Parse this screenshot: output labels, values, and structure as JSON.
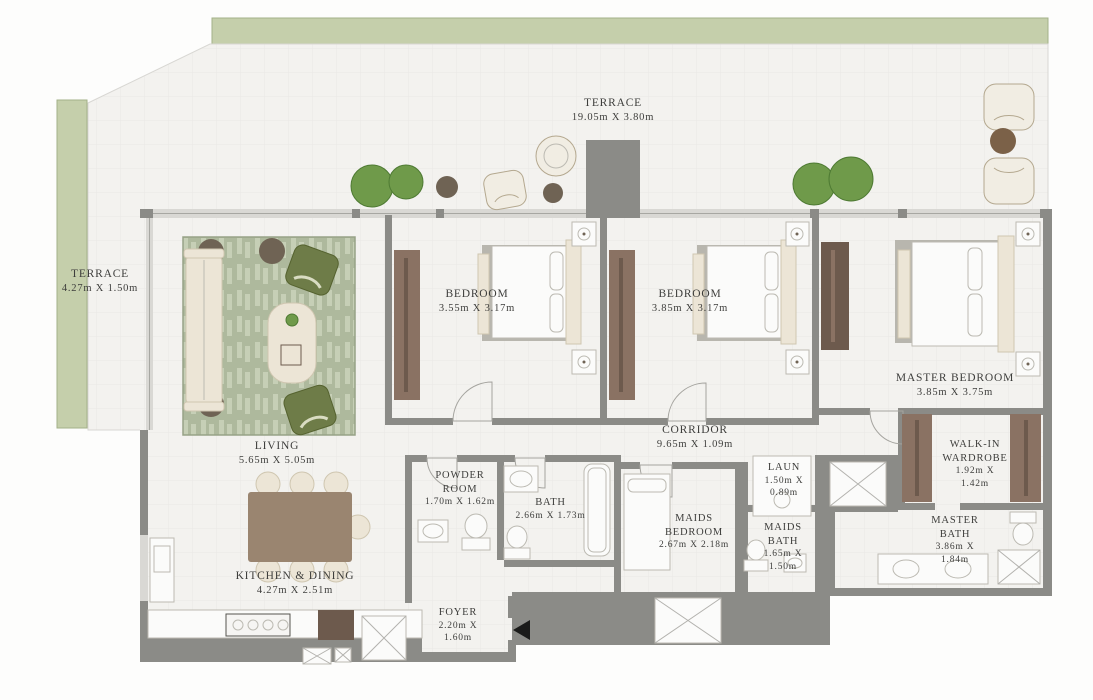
{
  "plan": {
    "type": "apartment-floor-plan",
    "rooms": {
      "terrace_top": {
        "name": "TERRACE",
        "dims": "19.05m X 3.80m"
      },
      "terrace_left": {
        "name": "TERRACE",
        "dims": "4.27m X 1.50m"
      },
      "bedroom_1": {
        "name": "BEDROOM",
        "dims": "3.55m X 3.17m"
      },
      "bedroom_2": {
        "name": "BEDROOM",
        "dims": "3.85m X 3.17m"
      },
      "master_bedroom": {
        "name": "MASTER BEDROOM",
        "dims": "3.85m X 3.75m"
      },
      "living": {
        "name": "LIVING",
        "dims": "5.65m X 5.05m"
      },
      "corridor": {
        "name": "CORRIDOR",
        "dims": "9.65m X 1.09m"
      },
      "powder_room": {
        "name": "POWDER\nROOM",
        "dims": "1.70m X 1.62m"
      },
      "bath": {
        "name": "BATH",
        "dims": "2.66m X 1.73m"
      },
      "laundry": {
        "name": "LAUN",
        "dims": "1.50m X\n0.89m"
      },
      "maids_bedroom": {
        "name": "MAIDS\nBEDROOM",
        "dims": "2.67m X 2.18m"
      },
      "maids_bath": {
        "name": "MAIDS\nBATH",
        "dims": "1.65m X\n1.50m"
      },
      "walk_in_wardrobe": {
        "name": "WALK-IN\nWARDROBE",
        "dims": "1.92m X\n1.42m"
      },
      "master_bath": {
        "name": "MASTER\nBATH",
        "dims": "3.86m X\n1.84m"
      },
      "kitchen_dining": {
        "name": "KITCHEN & DINING",
        "dims": "4.27m X 2.51m"
      },
      "foyer": {
        "name": "FOYER",
        "dims": "2.20m X\n1.60m"
      }
    },
    "icons": {
      "entrance": "entrance-arrow-left"
    },
    "colors": {
      "wall": "#8b8b87",
      "wall_light": "#d9d8d4",
      "wall_mid": "#a7a7a2",
      "planter": "#c5cfab",
      "planter_edge": "#a3b188",
      "rug_edge": "#97a287",
      "wood": "#9a8570",
      "wardrobe": "#8a7263",
      "wardrobe_dark": "#6d5a4d",
      "cream": "#ece5d6",
      "cream_edge": "#cfc6b0",
      "fixture_edge": "#bcbab2",
      "plant": "#6f9a4a",
      "plant_edge": "#4e7a33",
      "dark_table": "#6f6354",
      "arrow": "#1b1b1a",
      "text": "#3e3e3c"
    }
  }
}
